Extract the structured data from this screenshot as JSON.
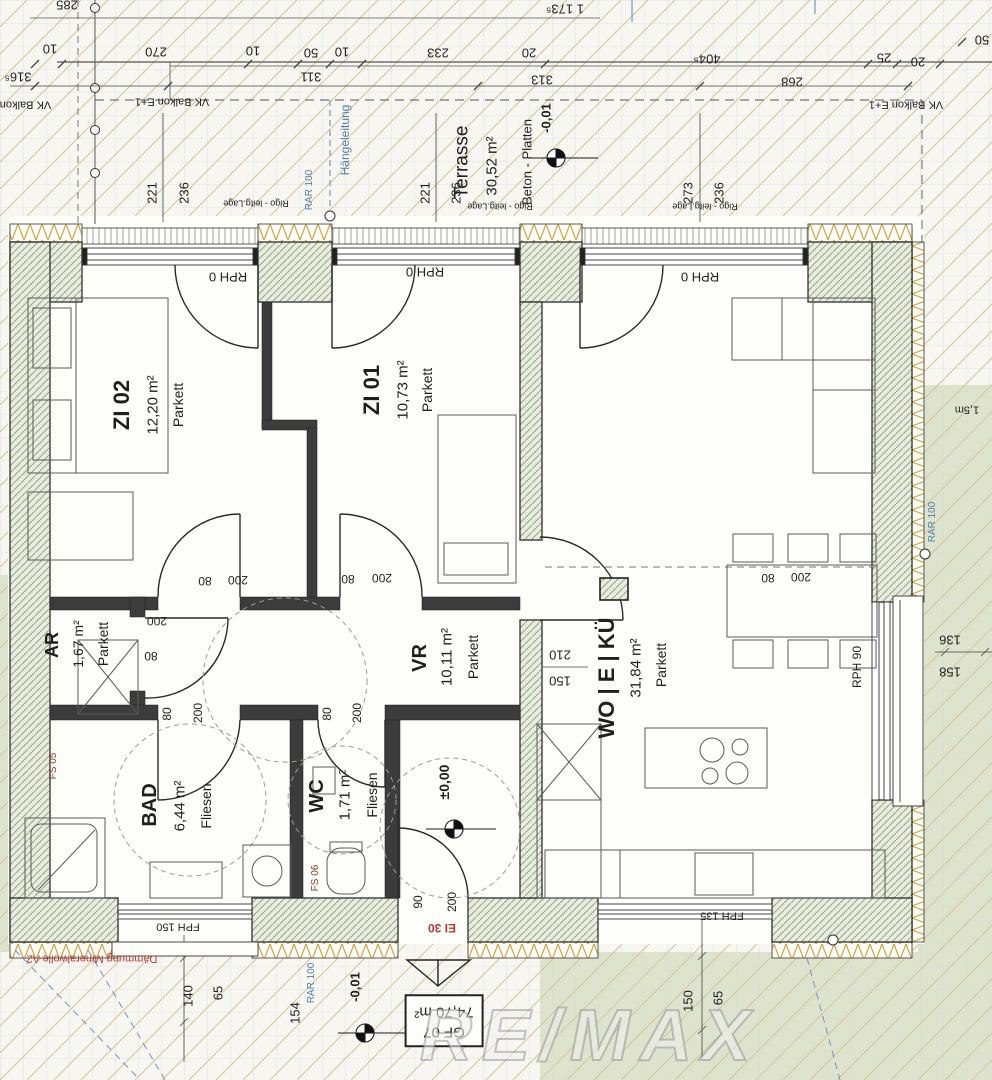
{
  "plan": {
    "unit_label": "GF 07",
    "unit_area": "74,70 m²",
    "watermark": "RE/MAX",
    "rooms": {
      "zi02": {
        "name": "ZI 02",
        "area": "12,20 m²",
        "floor": "Parkett"
      },
      "zi01": {
        "name": "ZI 01",
        "area": "10,73 m²",
        "floor": "Parkett"
      },
      "wo": {
        "name": "WO | E | KÜ",
        "area": "31,84 m²",
        "floor": "Parkett"
      },
      "vr": {
        "name": "VR",
        "area": "10,11 m²",
        "floor": "Parkett"
      },
      "ar": {
        "name": "AR",
        "area": "1,67 m²",
        "floor": "Parkett"
      },
      "bad": {
        "name": "BAD",
        "area": "6,44 m²",
        "floor": "Fliesen"
      },
      "wc": {
        "name": "WC",
        "area": "1,71 m²",
        "floor": "Fliesen"
      },
      "terrasse": {
        "name": "Terrasse",
        "area": "30,52 m²",
        "floor": "Beton - Platten"
      }
    },
    "levels": {
      "terrace": "-0,01",
      "entry": "±0,00",
      "outside": "-0,01"
    },
    "annotations": {
      "vk_balkon": "VK Balkon E+1",
      "haengeleitung": "Hängeleitung",
      "rar": "RAR 100",
      "rigo": "Rigo - leitg.Lage",
      "rph0": "RPH 0",
      "rph90": "RPH 90",
      "fph150": "FPH 150",
      "fph135": "FPH 135",
      "ei30": "EI 30",
      "fs05": "FS 05",
      "fs06": "FS 06",
      "daemmung": "Dämmung Mineralwolle A2",
      "dist": "1,5m"
    },
    "dims": {
      "top1": [
        "285",
        "1 173⁵"
      ],
      "top2": [
        "10",
        "270",
        "10",
        "50",
        "10",
        "233",
        "20",
        "404⁵",
        "25",
        "20",
        "50"
      ],
      "top3": [
        "316⁵",
        "311",
        "313",
        "268"
      ],
      "terrace_pairs": [
        "221",
        "236",
        "221",
        "236",
        "273",
        "236"
      ],
      "doors": [
        "80",
        "200",
        "80",
        "200",
        "80",
        "200"
      ],
      "door_ar": [
        "200",
        "80"
      ],
      "door_bad": [
        "80",
        "200"
      ],
      "door_wc": [
        "80",
        "200"
      ],
      "door_entry": [
        "90",
        "200"
      ],
      "niche": [
        "210",
        "150"
      ],
      "right": [
        "136",
        "158"
      ],
      "bottom_left": [
        "140",
        "65",
        "154"
      ],
      "bottom_right": [
        "150",
        "65"
      ]
    },
    "colors": {
      "accent_blue": "#4e7fae",
      "accent_red": "#b23b38",
      "wall_green": "#8fa58b",
      "terrain": "#dde3cd"
    }
  }
}
